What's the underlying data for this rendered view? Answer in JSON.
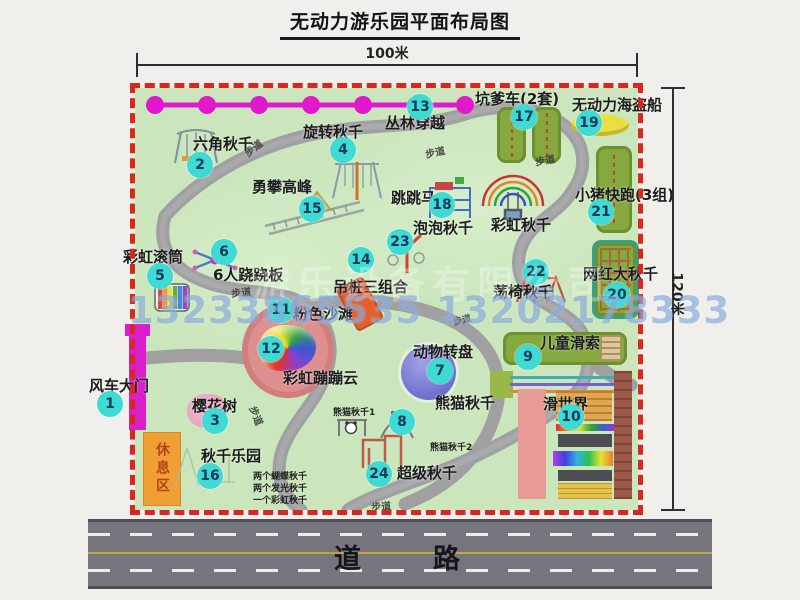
{
  "title": "无动力游乐园平面布局图",
  "dimensions": {
    "width_label": "100米",
    "height_label": "120米"
  },
  "road": {
    "label": "道　　路"
  },
  "watermark": {
    "company": "游乐设备有限公司",
    "phone": "13233865535 13202178333"
  },
  "rest_area": {
    "label": "休息区"
  },
  "colors": {
    "map_green": "#cbe6bd",
    "border_red": "#d8281c",
    "badge_teal": "#3ddbd3",
    "magenta": "#da1ecb",
    "path_gray": "#a0a0a2",
    "zone_green": "#86a93f",
    "rest_orange": "#ef9f33",
    "beach_pink": "#de8f8f",
    "disc_purple": "#7575cf",
    "boat_yellow": "#e9df42",
    "road_gray": "#75757d"
  },
  "map": {
    "path_label_text": "步道",
    "path_labels": [
      {
        "x": 108,
        "y": 52,
        "r": -38
      },
      {
        "x": 290,
        "y": 56,
        "r": -12
      },
      {
        "x": 400,
        "y": 64,
        "r": -10
      },
      {
        "x": 96,
        "y": 196,
        "r": -6
      },
      {
        "x": 318,
        "y": 225,
        "r": -14,
        "s": 9
      },
      {
        "x": 112,
        "y": 320,
        "r": 68
      },
      {
        "x": 236,
        "y": 410,
        "r": -4
      }
    ],
    "attractions": [
      {
        "id": "windmill-gate",
        "num": "1",
        "label": "风车大门",
        "label_pos": {
          "x": -46,
          "y": 287
        },
        "badge": {
          "x": -38,
          "y": 303
        }
      },
      {
        "id": "hex-swing",
        "num": "2",
        "label": "六角秋千",
        "label_pos": {
          "x": 58,
          "y": 45
        },
        "badge": {
          "x": 52,
          "y": 64
        }
      },
      {
        "id": "cherry-tree",
        "num": "3",
        "label": "樱花树",
        "label_pos": {
          "x": 57,
          "y": 307
        },
        "badge": {
          "x": 67,
          "y": 320
        }
      },
      {
        "id": "rotate-swing",
        "num": "4",
        "label": "旋转秋千",
        "label_pos": {
          "x": 168,
          "y": 33
        },
        "badge": {
          "x": 195,
          "y": 49
        }
      },
      {
        "id": "rainbow-roller",
        "num": "5",
        "label": "彩虹滚筒",
        "label_pos": {
          "x": -12,
          "y": 158
        },
        "badge": {
          "x": 12,
          "y": 175
        }
      },
      {
        "id": "seesaw-6p",
        "num": "6",
        "label": "6人跷跷板",
        "label_pos": {
          "x": 78,
          "y": 176
        },
        "badge": {
          "x": 76,
          "y": 151
        }
      },
      {
        "id": "animal-disc",
        "num": "7",
        "label": "动物转盘",
        "label_pos": {
          "x": 278,
          "y": 253
        },
        "badge": {
          "x": 292,
          "y": 270
        }
      },
      {
        "id": "panda-swing",
        "num": "8",
        "label": "熊猫秋千",
        "label_pos": {
          "x": 300,
          "y": 304
        },
        "badge": {
          "x": 254,
          "y": 321
        },
        "subs": [
          {
            "text": "熊猫秋千1",
            "x": 198,
            "y": 317
          },
          {
            "text": "熊猫秋千2",
            "x": 295,
            "y": 352
          }
        ]
      },
      {
        "id": "kids-zipline",
        "num": "9",
        "label": "儿童滑索",
        "label_pos": {
          "x": 405,
          "y": 244
        },
        "badge": {
          "x": 380,
          "y": 256
        }
      },
      {
        "id": "slide-world",
        "num": "10",
        "label": "滑世界",
        "label_pos": {
          "x": 408,
          "y": 305
        },
        "badge": {
          "x": 423,
          "y": 316
        }
      },
      {
        "id": "pink-beach",
        "num": "11",
        "label": "粉色沙滩",
        "label_pos": {
          "x": 158,
          "y": 215
        },
        "badge": {
          "x": 133,
          "y": 209
        }
      },
      {
        "id": "rainbow-cloud",
        "num": "12",
        "label": "彩虹蹦蹦云",
        "label_pos": {
          "x": 148,
          "y": 279
        },
        "badge": {
          "x": 123,
          "y": 248
        }
      },
      {
        "id": "jungle-cross",
        "num": "13",
        "label": "丛林穿越",
        "label_pos": {
          "x": 250,
          "y": 24
        },
        "badge": {
          "x": 272,
          "y": 6
        }
      },
      {
        "id": "hang-piles",
        "num": "14",
        "label": "吊桩三组合",
        "label_pos": {
          "x": 198,
          "y": 188
        },
        "badge": {
          "x": 213,
          "y": 159
        }
      },
      {
        "id": "climb-peak",
        "num": "15",
        "label": "勇攀高峰",
        "label_pos": {
          "x": 117,
          "y": 88
        },
        "badge": {
          "x": 164,
          "y": 108
        }
      },
      {
        "id": "swing-park",
        "num": "16",
        "label": "秋千乐园",
        "label_pos": {
          "x": 66,
          "y": 357
        },
        "badge": {
          "x": 62,
          "y": 375
        },
        "subs": [
          {
            "text": "两个蝴蝶秋千",
            "x": 118,
            "y": 381
          },
          {
            "text": "两个发光秋千",
            "x": 118,
            "y": 393
          },
          {
            "text": "一个彩虹秋千",
            "x": 118,
            "y": 405
          }
        ]
      },
      {
        "id": "troll-cart",
        "num": "17",
        "label": "坑爹车(2套)",
        "label_pos": {
          "x": 340,
          "y": 0
        },
        "badge": {
          "x": 376,
          "y": 16
        }
      },
      {
        "id": "jump-horse",
        "num": "18",
        "label": "跳跳马",
        "label_pos": {
          "x": 256,
          "y": 99
        },
        "badge": {
          "x": 294,
          "y": 104
        }
      },
      {
        "id": "pirate-ship",
        "num": "19",
        "label": "无动力海盗船",
        "label_pos": {
          "x": 437,
          "y": 6
        },
        "badge": {
          "x": 441,
          "y": 22
        }
      },
      {
        "id": "big-swing",
        "num": "20",
        "label": "网红大秋千",
        "label_pos": {
          "x": 448,
          "y": 175
        },
        "badge": {
          "x": 469,
          "y": 194
        }
      },
      {
        "id": "piggy-run",
        "num": "21",
        "label": "小猪快跑(3组)",
        "label_pos": {
          "x": 440,
          "y": 96
        },
        "badge": {
          "x": 453,
          "y": 111
        }
      },
      {
        "id": "chair-swing",
        "num": "22",
        "label": "荡椅秋千",
        "label_pos": {
          "x": 358,
          "y": 193
        },
        "badge": {
          "x": 388,
          "y": 171
        }
      },
      {
        "id": "bubble-swing",
        "num": "23",
        "label": "泡泡秋千",
        "label_pos": {
          "x": 278,
          "y": 129
        },
        "badge": {
          "x": 252,
          "y": 141
        }
      },
      {
        "id": "super-swing",
        "num": "24",
        "label": "超级秋千",
        "label_pos": {
          "x": 262,
          "y": 374
        },
        "badge": {
          "x": 231,
          "y": 373
        }
      },
      {
        "id": "rainbow-swing",
        "num": null,
        "label": "彩虹秋千",
        "label_pos": {
          "x": 356,
          "y": 126
        }
      }
    ]
  }
}
